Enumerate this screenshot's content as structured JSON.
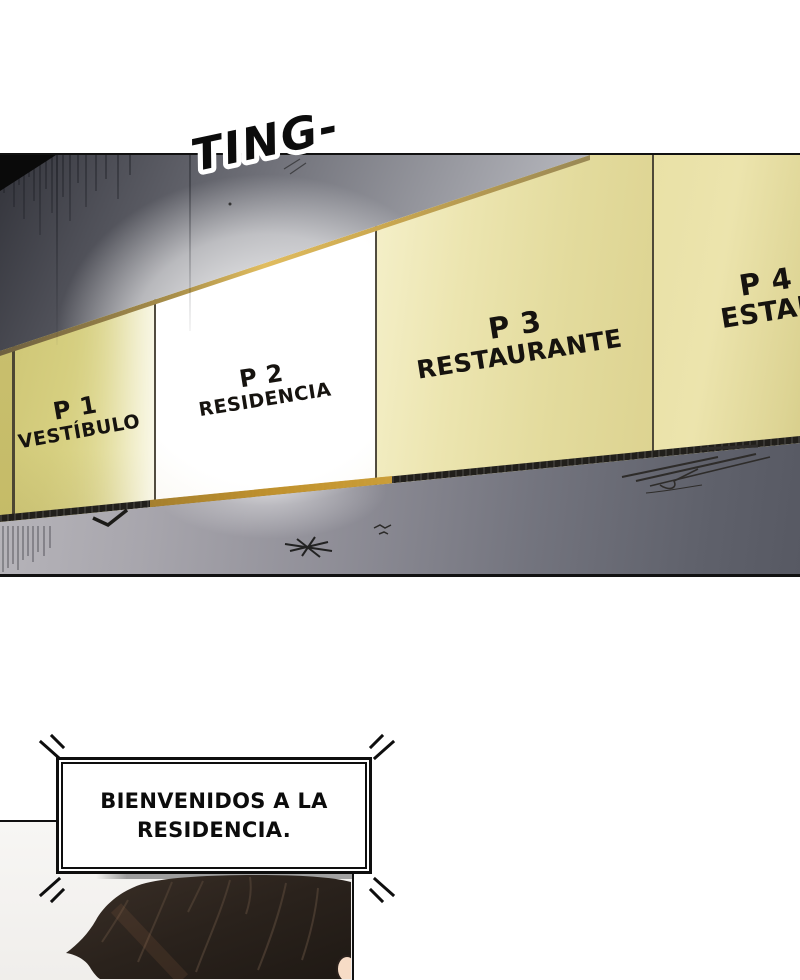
{
  "sound_effect": {
    "text": "TING-"
  },
  "floor_sign": {
    "panels": [
      {
        "floor": "P 1",
        "label": "VESTÍBULO",
        "lit": false
      },
      {
        "floor": "P 2",
        "label": "RESIDENCIA",
        "lit": true
      },
      {
        "floor": "P 3",
        "label": "RESTAURANTE",
        "lit": false
      },
      {
        "floor": "P 4",
        "label": "ESTAD",
        "lit": false
      }
    ]
  },
  "announcement": {
    "line1": "BIENVENIDOS A LA",
    "line2": "RESIDENCIA."
  },
  "colors": {
    "sign_yellow": "#ddd592",
    "lit_panel": "#ffffff",
    "gold_trim": "#c9a24e",
    "rail_dark": "#211f1b",
    "wall_dark": "#3a3b42",
    "wall_light": "#b7b5bb",
    "hair_brown": "#2b231d",
    "skin_tone": "#f6dcc6",
    "ink": "#0e0e0e"
  }
}
